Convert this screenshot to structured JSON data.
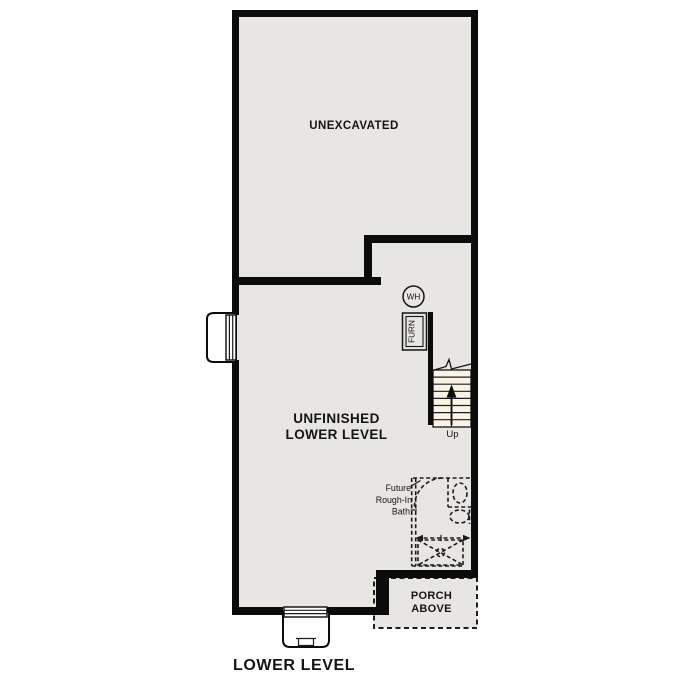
{
  "page": {
    "title": "LOWER LEVEL"
  },
  "colors": {
    "wall": "#0b0b0b",
    "floor_fill": "#e8e6e3",
    "stair_tread_fill": "#f9f4e5",
    "background": "#ffffff",
    "line": "#1c1c1c"
  },
  "areas": {
    "unexcavated": {
      "label": "UNEXCAVATED"
    },
    "main": {
      "line1": "UNFINISHED",
      "line2": "LOWER LEVEL"
    },
    "bath": {
      "line1": "Future",
      "line2": "Rough-In",
      "line3": "Bath"
    },
    "porch": {
      "line1": "PORCH",
      "line2": "ABOVE"
    }
  },
  "fixtures": {
    "water_heater_label": "WH",
    "furnace_label": "FURN"
  },
  "stairs": {
    "up_label": "Up"
  }
}
